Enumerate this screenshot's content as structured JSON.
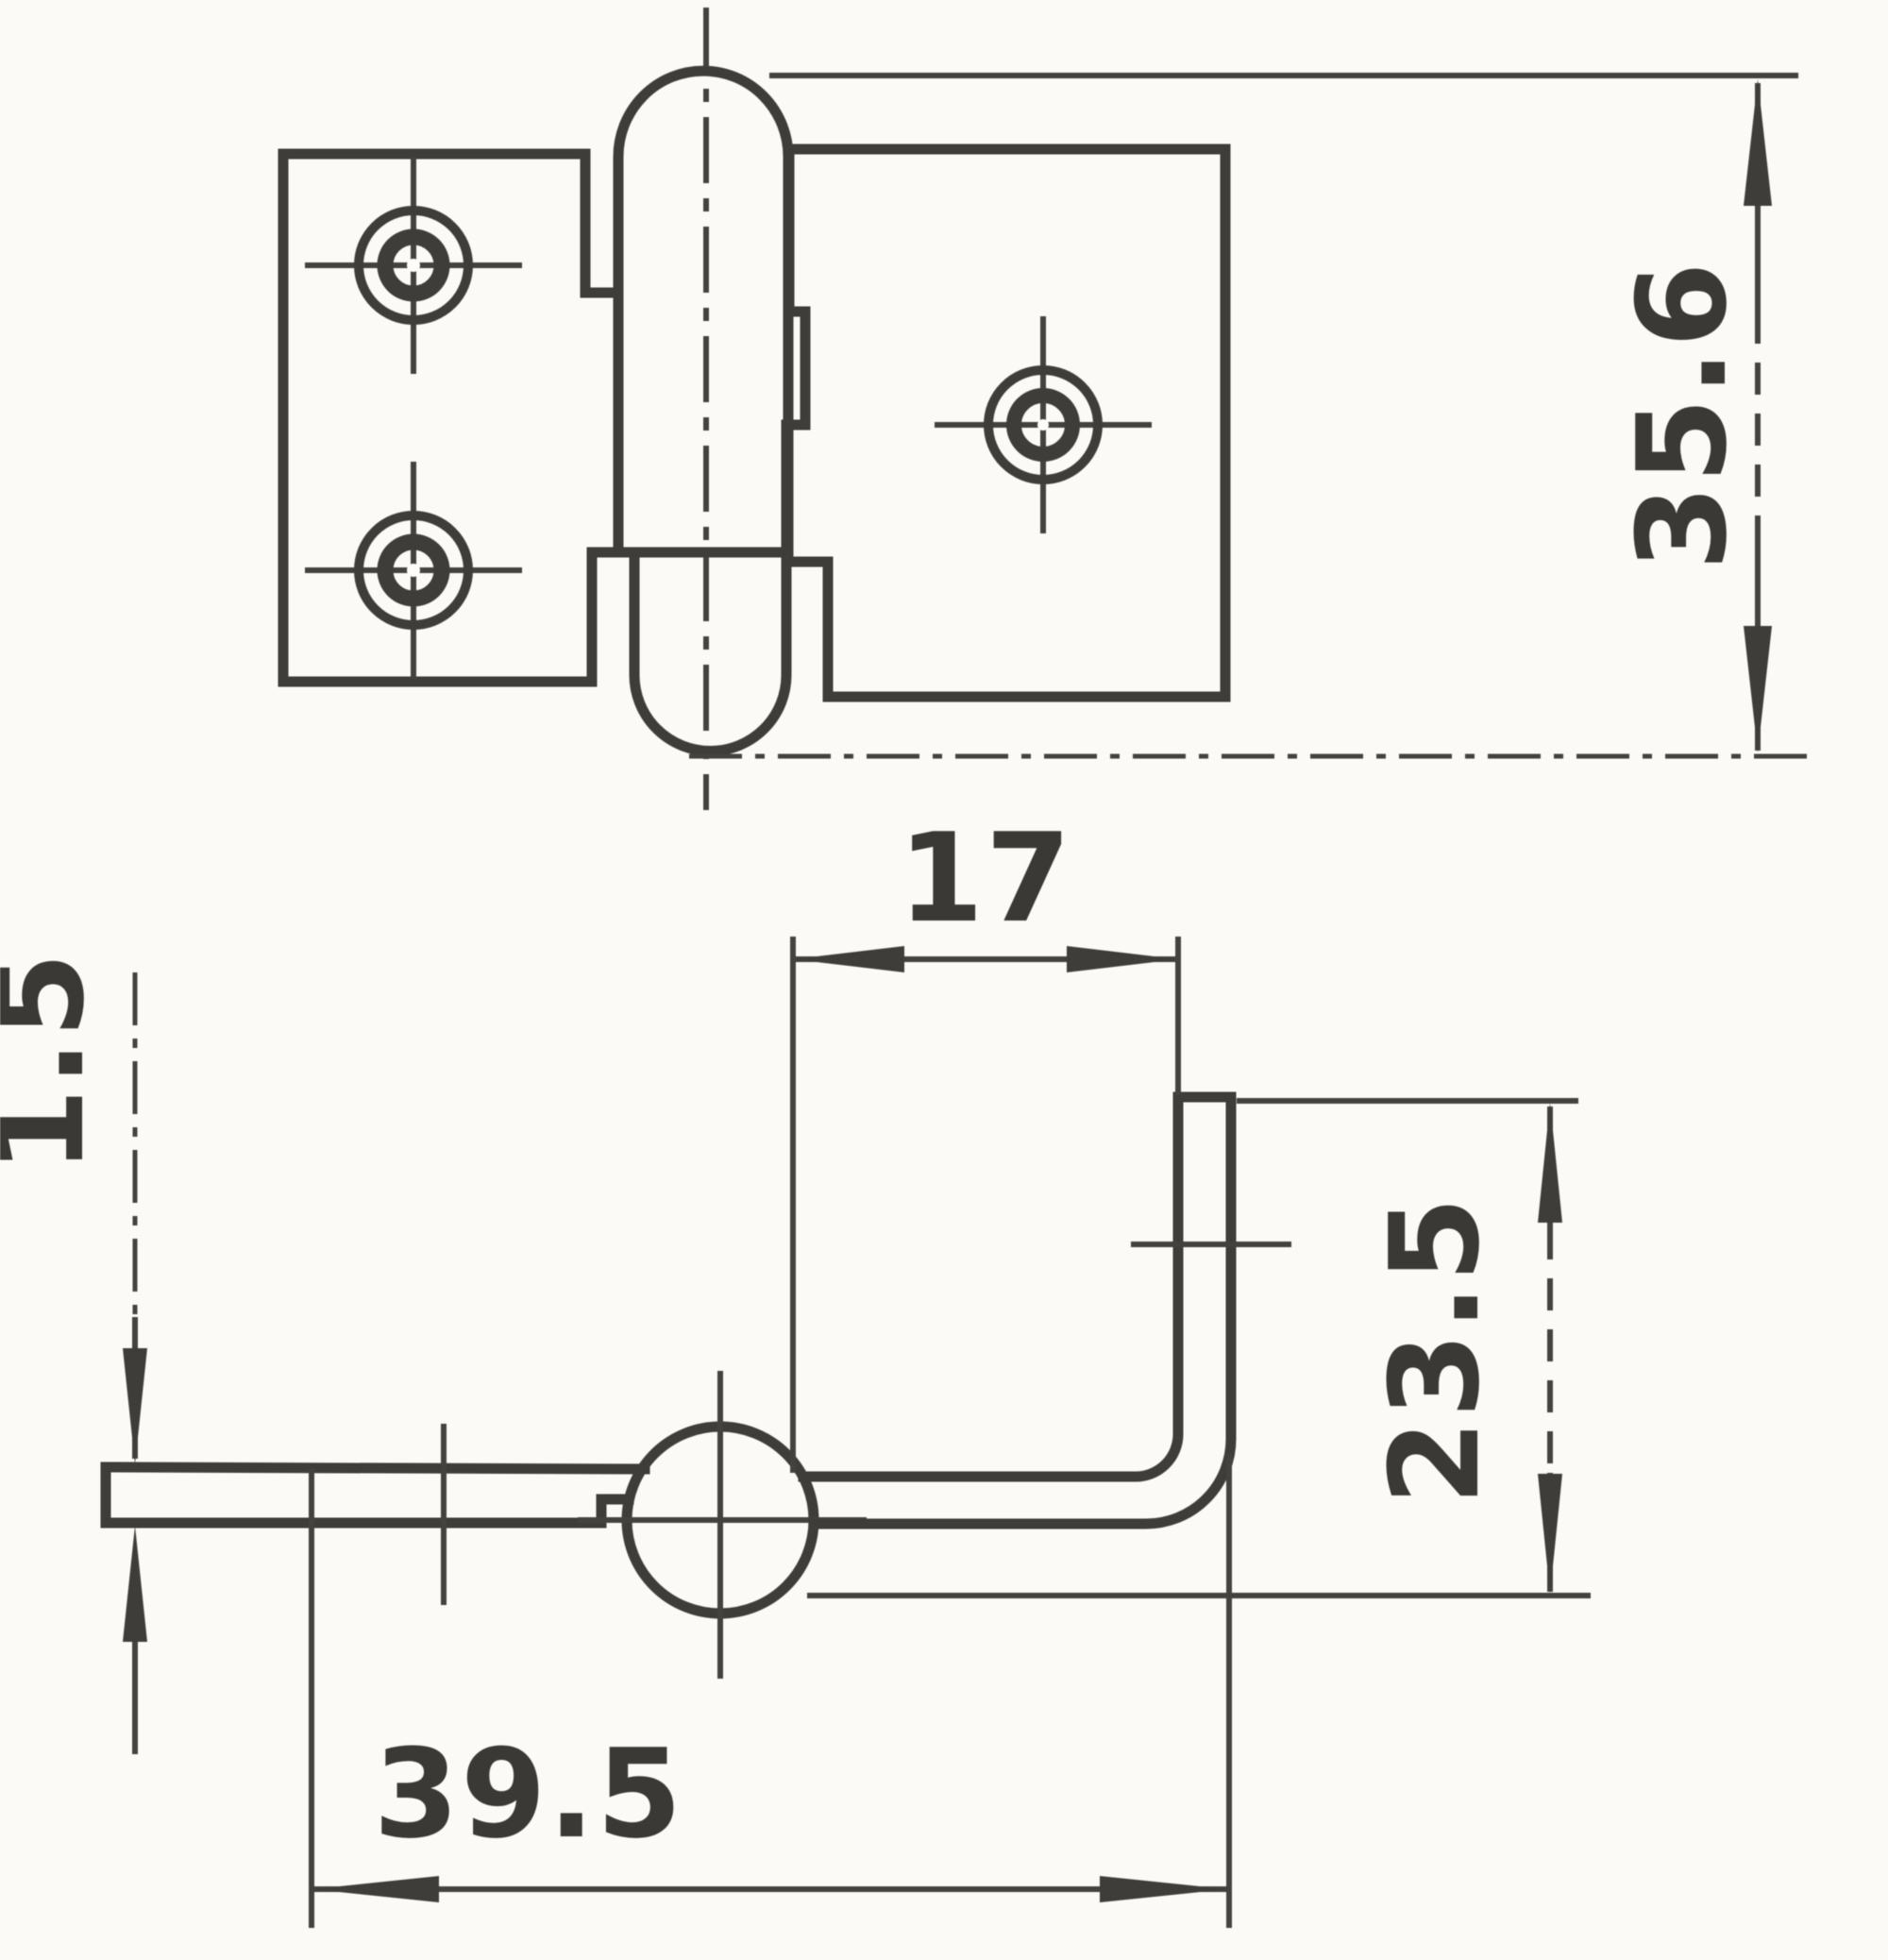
{
  "palette": {
    "paper": "#fbfaf7",
    "ink": "#403e3a"
  },
  "plan_view": {
    "left_leaf_screw_holes": 2,
    "right_leaf_screw_holes": 1
  },
  "dimensions": {
    "barrel_length": "35.6",
    "leaf_inset": "17",
    "leaf_thickness": "1.5",
    "bracket_height": "23.5",
    "overall_length": "39.5"
  }
}
